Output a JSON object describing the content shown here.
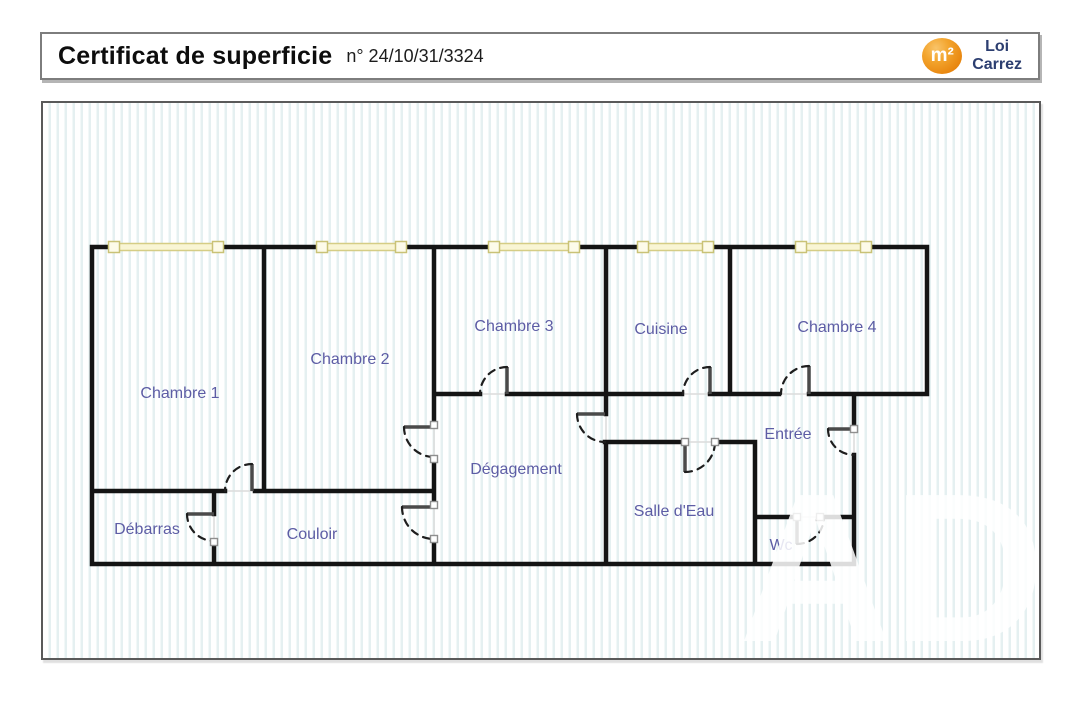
{
  "header": {
    "title": "Certificat de superficie",
    "number": "n° 24/10/31/3324",
    "logo": {
      "badge": "m²",
      "line1": "Loi",
      "line2": "Carrez"
    }
  },
  "plan": {
    "rooms": [
      {
        "id": "chambre-1",
        "label": "Chambre 1"
      },
      {
        "id": "chambre-2",
        "label": "Chambre 2"
      },
      {
        "id": "chambre-3",
        "label": "Chambre 3"
      },
      {
        "id": "cuisine",
        "label": "Cuisine"
      },
      {
        "id": "chambre-4",
        "label": "Chambre 4"
      },
      {
        "id": "entree",
        "label": "Entrée"
      },
      {
        "id": "degagement",
        "label": "Dégagement"
      },
      {
        "id": "salle-d-eau",
        "label": "Salle d'Eau"
      },
      {
        "id": "couloir",
        "label": "Couloir"
      },
      {
        "id": "debarras",
        "label": "Débarras"
      },
      {
        "id": "wc",
        "label": "Wc"
      }
    ],
    "window_count": 5,
    "door_count": 11
  },
  "watermark": {
    "text": "AD"
  },
  "colors": {
    "room_label": "#5d5da5",
    "wall": "#141414",
    "window_fill": "#f9f5d4",
    "window_border": "#d5cd85",
    "logo_orange": "#ee8a12",
    "logo_navy": "#2c3e70",
    "stripe": "#e5f0f1",
    "header_border": "#7d7d7d"
  }
}
